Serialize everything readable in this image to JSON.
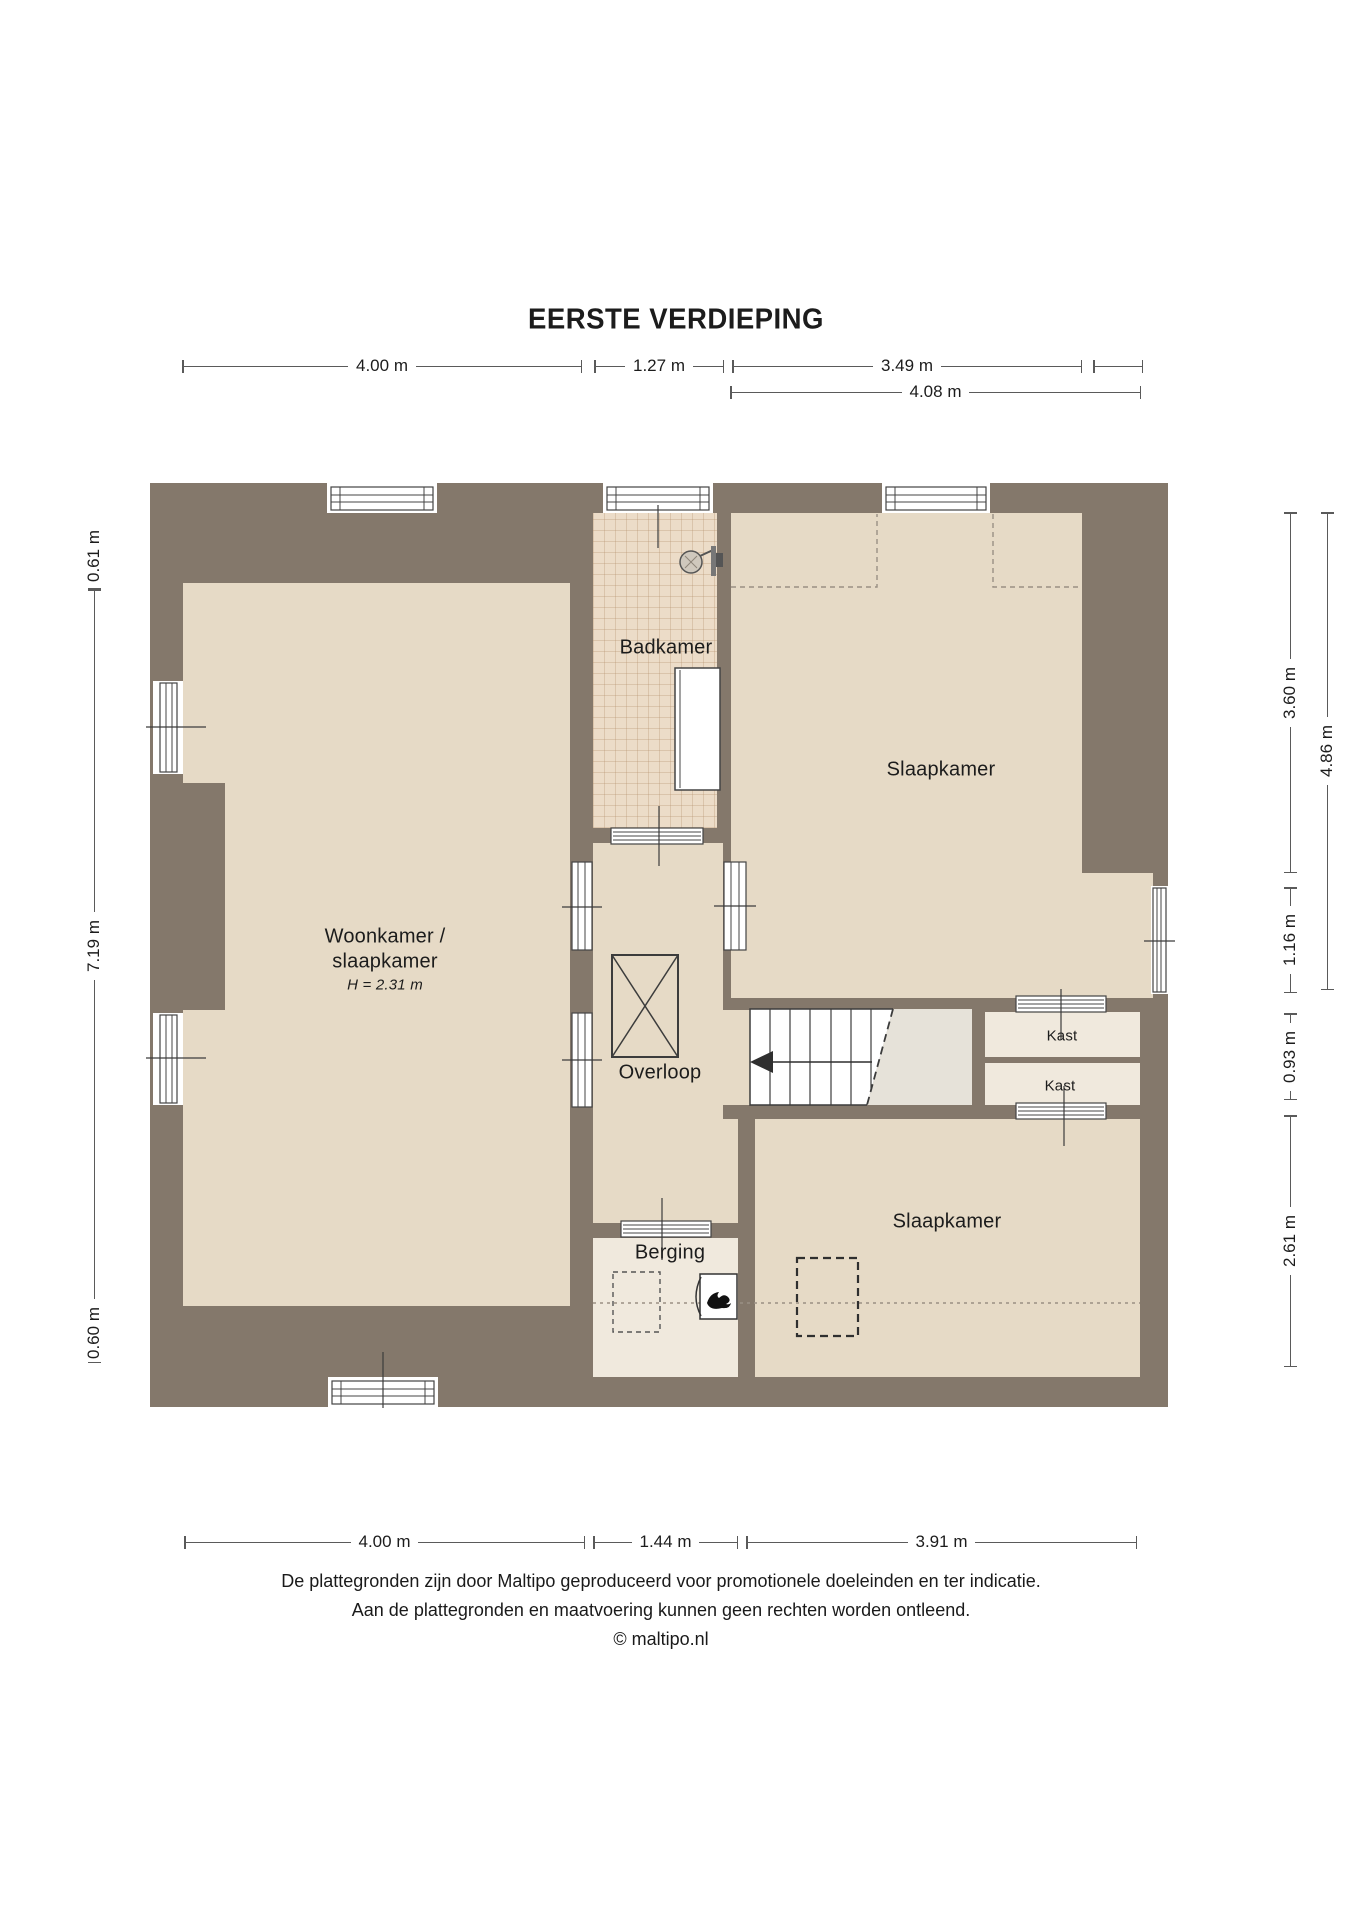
{
  "title": "EERSTE VERDIEPING",
  "rooms": {
    "badkamer": "Badkamer",
    "slaapkamer_top": "Slaapkamer",
    "woonkamer_line1": "Woonkamer /",
    "woonkamer_line2": "slaapkamer",
    "woonkamer_height": "H = 2.31 m",
    "overloop": "Overloop",
    "kast_top": "Kast",
    "kast_bottom": "Kast",
    "berging": "Berging",
    "slaapkamer_bottom": "Slaapkamer"
  },
  "dims": {
    "top1_a": "4.00 m",
    "top1_b": "1.27 m",
    "top1_c": "3.49 m",
    "top2_a": "4.08 m",
    "left_a": "0.61 m",
    "left_b": "7.19 m",
    "left_c": "0.60 m",
    "right_a": "3.60 m",
    "right_b": "1.16 m",
    "right_c": "0.93 m",
    "right_d": "2.61 m",
    "right_e": "4.86 m",
    "bottom_a": "4.00 m",
    "bottom_b": "1.44 m",
    "bottom_c": "3.91 m"
  },
  "footer": {
    "line1": "De plattegronden zijn door Maltipo geproduceerd voor promotionele doeleinden en ter indicatie.",
    "line2": "Aan de plattegronden en maatvoering kunnen geen rechten worden ontleend.",
    "line3": "© maltipo.nl"
  },
  "colors": {
    "wall": "#84786b",
    "floor": "#e6dac6",
    "tile": "#ecdcc8",
    "closet": "#f0e9dd",
    "under_stairs": "#e6e2d9",
    "line": "#3c3c3c"
  }
}
